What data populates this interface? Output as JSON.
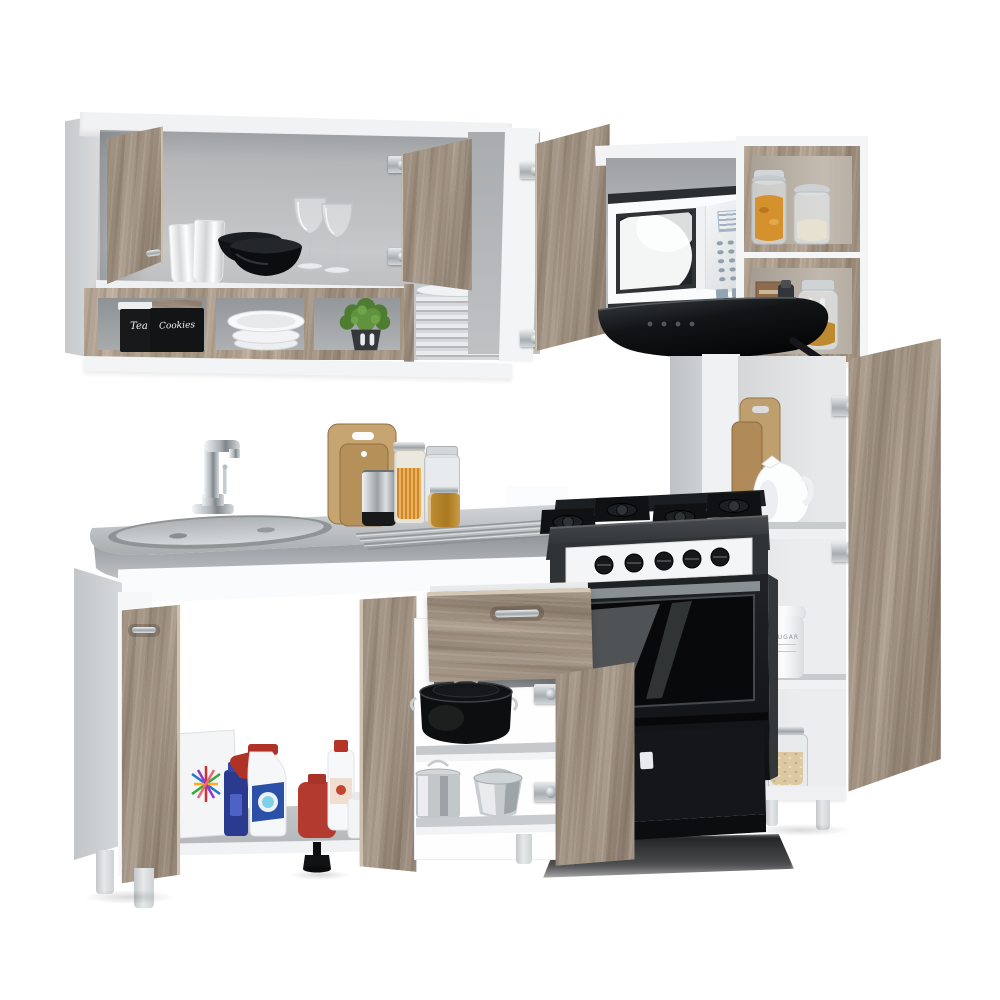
{
  "scene": {
    "type": "product-photo",
    "subject": "Modular kitchen set with open wall cabinets, sink counter, pantry tower, microwave, range hood and black gas stove",
    "background": "#ffffff"
  },
  "labels": {
    "tea": "Tea",
    "cookies": "Cookies",
    "sugar": "SUGAR"
  },
  "palette": {
    "wood": "#a39484",
    "wood_light": "#cabca9",
    "wood_dark": "#8a7c6e",
    "carcass_white": "#f4f5f6",
    "side_gray": "#ccced0",
    "interior_gray": "#b5b7b9",
    "counter_steel": "#b7bbbe",
    "appliance_black": "#1b1d20",
    "plant_green": "#578c38",
    "honey_amber": "#bd8c33",
    "cleaner_red": "#b23a2e",
    "cleaner_blue": "#2c3f9f"
  },
  "objects": {
    "wall_unit": [
      "open-wall-cabinet",
      "glass-tumblers",
      "black-bowls",
      "wine-glasses",
      "tea-canister",
      "cookies-canister",
      "white-bowl-stack",
      "potted-plant",
      "plate-stack",
      "microwave",
      "range-hood",
      "pasta-jars",
      "honey-jar"
    ],
    "base_unit": [
      "sink-counter",
      "faucet",
      "cutting-boards",
      "pepper-grinder",
      "spice-jars",
      "cleaning-supplies",
      "open-drawer",
      "black-stock-pot",
      "steel-pot",
      "steel-kettle",
      "gas-stove"
    ],
    "pantry": [
      "cutting-board",
      "ceramic-jug",
      "sugar-canister",
      "grain-jar"
    ]
  }
}
